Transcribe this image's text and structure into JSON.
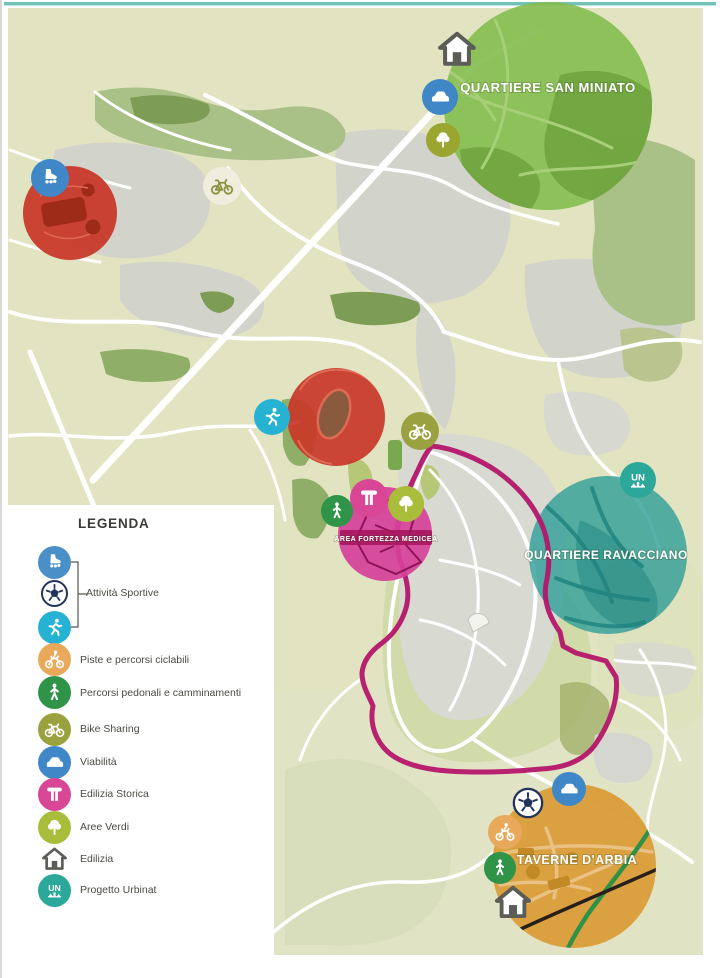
{
  "legend": {
    "title": "LEGENDA",
    "sports": {
      "label": "Attività Sportive",
      "icons": [
        "roller-skate-icon",
        "soccer-ball-icon",
        "runner-icon"
      ]
    },
    "items": [
      {
        "icon": "cyclist-icon",
        "label": "Piste e percorsi ciclabili"
      },
      {
        "icon": "walker-icon",
        "label": "Percorsi pedonali e camminamenti"
      },
      {
        "icon": "bicycle-icon",
        "label": "Bike Sharing"
      },
      {
        "icon": "car-icon",
        "label": "Viabilità"
      },
      {
        "icon": "historic-monument-icon",
        "label": "Edilizia Storica"
      },
      {
        "icon": "tree-icon",
        "label": "Aree Verdi"
      },
      {
        "icon": "house-icon",
        "label": "Edilizia"
      },
      {
        "icon": "urbinat-icon",
        "label": "Progetto Urbinat"
      }
    ]
  },
  "map": {
    "regions": [
      {
        "id": "quartiere-san-miniato",
        "label": "QUARTIERE SAN MINIATO",
        "color": "#84bc4e"
      },
      {
        "id": "quartiere-ravacciano",
        "label": "QUARTIERE RAVACCIANO",
        "color": "#2f9e97"
      },
      {
        "id": "taverne-darbia",
        "label": "TAVERNE D'ARBIA",
        "color": "#db9f3c"
      },
      {
        "id": "area-fortezza-medicea",
        "label": "AREA FORTEZZA MEDICEA",
        "color": "#d5429a"
      },
      {
        "id": "area-rossa-nordovest",
        "label": "",
        "color": "#c8392a"
      },
      {
        "id": "area-rossa-stadio",
        "label": "",
        "color": "#c8392a"
      }
    ],
    "route": {
      "color": "#b4166b"
    },
    "markers": [
      {
        "icon": "roller-skate-icon",
        "color": "#3f87c7"
      },
      {
        "icon": "bike-station-icon",
        "color": "#efeede"
      },
      {
        "icon": "runner-icon",
        "color": "#26b2d2"
      },
      {
        "icon": "bike-sharing-icon",
        "color": "#99a23f"
      },
      {
        "icon": "walker-icon",
        "color": "#2f9447"
      },
      {
        "icon": "historic-monument-icon",
        "color": "#d84695"
      },
      {
        "icon": "tree-icon",
        "color": "#a9bd3a"
      },
      {
        "icon": "house-icon",
        "color": "#ffffff"
      },
      {
        "icon": "car-icon",
        "color": "#3f87c7"
      },
      {
        "icon": "tree-icon",
        "color": "#9aa62f"
      },
      {
        "icon": "urbinat-icon",
        "color": "#2ca89a"
      },
      {
        "icon": "car-icon",
        "color": "#3f87c7"
      },
      {
        "icon": "soccer-ball-icon",
        "color": "#ffffff"
      },
      {
        "icon": "cyclist-icon",
        "color": "#e8a95b"
      },
      {
        "icon": "walker-icon",
        "color": "#2f9447"
      },
      {
        "icon": "house-icon",
        "color": "#ffffff"
      }
    ]
  },
  "icons": {
    "urbinat_text": "UN"
  },
  "palette": {
    "map_background": "#e2e3c1",
    "roads": "#ffffff",
    "buildings": "#d2d3cb",
    "green_areas": "#a9c087",
    "route_line": "#b4166b",
    "top_border": "#72c3b6",
    "taverne_river": "#2e9147",
    "taverne_railway": "#262019"
  }
}
